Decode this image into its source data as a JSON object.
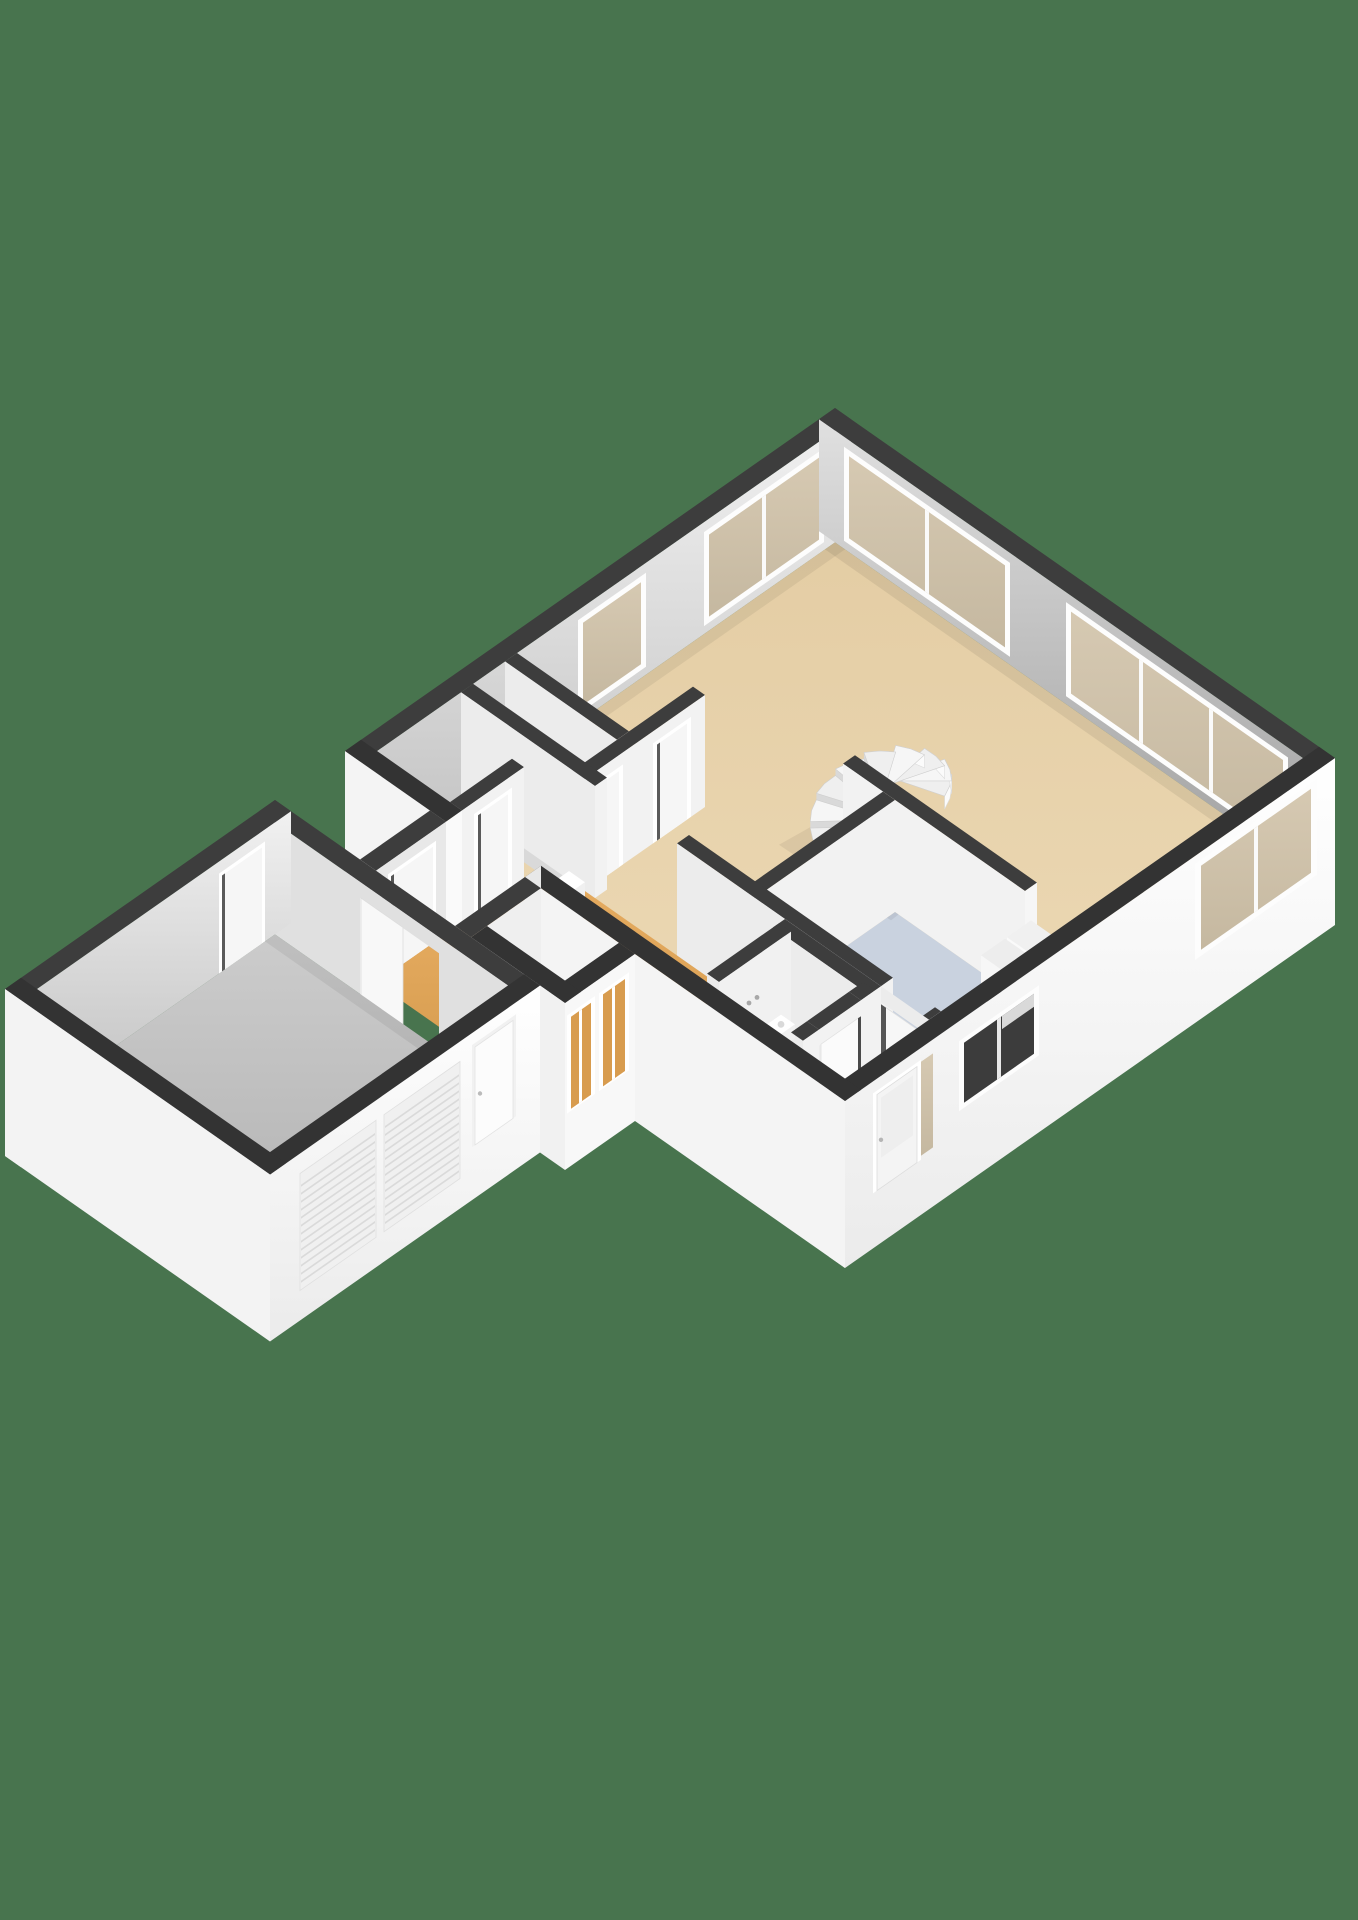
{
  "image": {
    "kind": "3d-floorplan-isometric-render",
    "width": 1358,
    "height": 1920,
    "visible_text": "none"
  },
  "palette": {
    "background": "#48744E",
    "wall_cap_dark": "#3d3d3d",
    "wall_cap_near": "#333333",
    "wall_exterior_white": "#fbfbfb",
    "wall_exterior_shade": "#f0f0f0",
    "wall_interior_nw_light": "#efefef",
    "wall_interior_nw_dark": "#c2c2c2",
    "wall_interior_ne_light": "#dedede",
    "wall_interior_ne_dark": "#a2a2a2",
    "partition_face": "#f2f2f2",
    "partition_face_shade": "#ececec",
    "floor_living_tan": "#e7d2ab",
    "floor_living_tan_light": "#eedcb9",
    "floor_kitchen_blue": "#c9d2df",
    "floor_wood_orange": "#e2a65c",
    "floor_wood_orange_dark": "#d89c4f",
    "floor_garage_gray": "#c9c9c9",
    "floor_garage_gray_dark": "#b3b3b3",
    "floor_storage_gray": "#d9d9d9",
    "window_glass_tan": "#cdc0a9",
    "window_glass_dark": "#3c3c3c",
    "window_frame_white": "#fdfdfd",
    "fixture_white": "#ffffff",
    "appliance_panel_dark": "#262626",
    "stair_step_white": "#f6f6f6"
  },
  "scene": {
    "level": "ground-floor",
    "rooms": [
      {
        "id": "living-room",
        "floor": "tan"
      },
      {
        "id": "kitchen",
        "floor": "blue-gray"
      },
      {
        "id": "entry-hall",
        "floor": "tan"
      },
      {
        "id": "wc",
        "floor": "tan"
      },
      {
        "id": "hallway",
        "floor": "wood"
      },
      {
        "id": "corridor",
        "floor": "wood"
      },
      {
        "id": "side-annex",
        "floor": "wood"
      },
      {
        "id": "storage-room-1",
        "floor": "gray"
      },
      {
        "id": "storage-room-2",
        "floor": "gray"
      },
      {
        "id": "closet",
        "floor": "gray"
      },
      {
        "id": "garage",
        "floor": "gray"
      }
    ],
    "fixtures": [
      "spiral-staircase",
      "kitchen-tall-cabinets",
      "built-in-appliance-panel",
      "toilet-with-cistern",
      "wc-washbasin",
      "hall-washbasin",
      "wall-outlet"
    ],
    "openings": {
      "windows": [
        "nw-wall-window-near-apex",
        "nw-wall-window-over-storage",
        "ne-wall-window-band-left",
        "ne-wall-window-band-right",
        "se-wall-window-near-east-corner",
        "se-kitchen-window-dark",
        "front-door-sidelight"
      ],
      "doors": [
        "front-door",
        "storage-room-door-1",
        "storage-room-door-2",
        "closet-door",
        "wc-door",
        "kitchen-entry-door",
        "corridor-exterior-door",
        "garage-side-door",
        "garage-interior-door",
        "garage-nw-door",
        "annex-glass-door-1",
        "annex-glass-door-2",
        "garage-roller-door-1",
        "garage-roller-door-2"
      ]
    }
  }
}
